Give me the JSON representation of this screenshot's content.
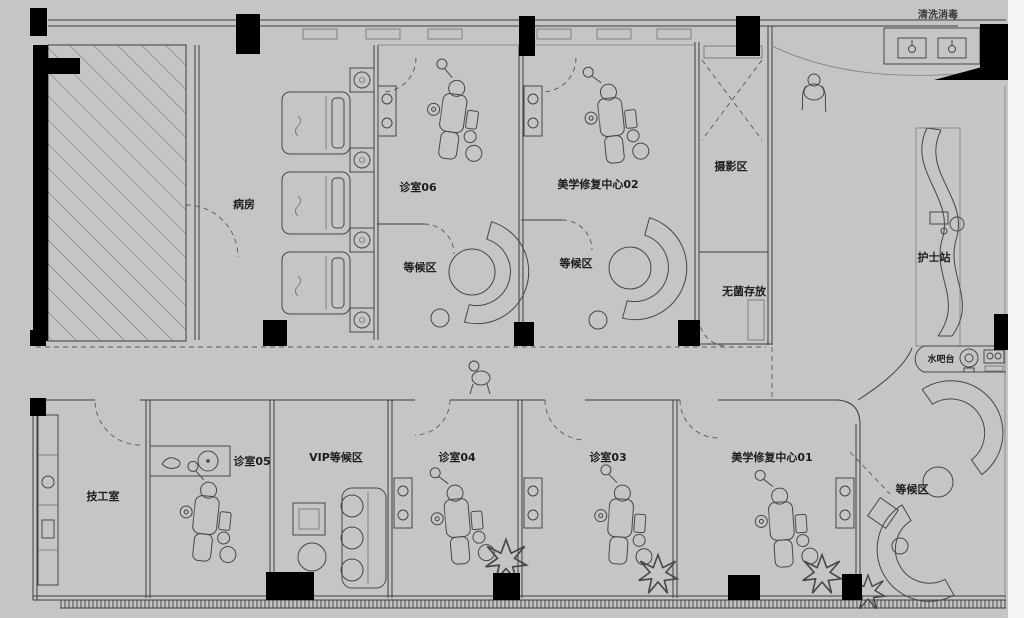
{
  "meta": {
    "drawing_type": "dental-clinic-floor-plan",
    "style": "CAD line drawing on gray background"
  },
  "colors": {
    "background": "#c5c5c5",
    "walls": "#000000",
    "lines": "#3d3d3d",
    "light_lines": "#7c7c7c",
    "paper_edge_right": "#f5f5f5",
    "label_text": "#1d1d1d"
  },
  "labels": {
    "ward": "病房",
    "clinic_06": "诊室06",
    "aesthetic_center_02": "美学修复中心02",
    "photo_area": "摄影区",
    "waiting_top_left": "等候区",
    "waiting_top_right": "等候区",
    "sterile_storage": "无菌存放",
    "nurse_station": "护士站",
    "water_bar": "水吧台",
    "wash_area_top": "清洗消毒",
    "technician_room": "技工室",
    "clinic_05": "诊室05",
    "vip_waiting": "VIP等候区",
    "clinic_04": "诊室04",
    "clinic_03": "诊室03",
    "aesthetic_center_01": "美学修复中心01",
    "waiting_lobby": "等候区"
  },
  "icons": [
    "dental-chair-icon",
    "bed-icon",
    "round-table-icon",
    "curved-sofa-icon",
    "plant-icon",
    "sink-icon",
    "person-icon",
    "coffee-machine-icon"
  ]
}
